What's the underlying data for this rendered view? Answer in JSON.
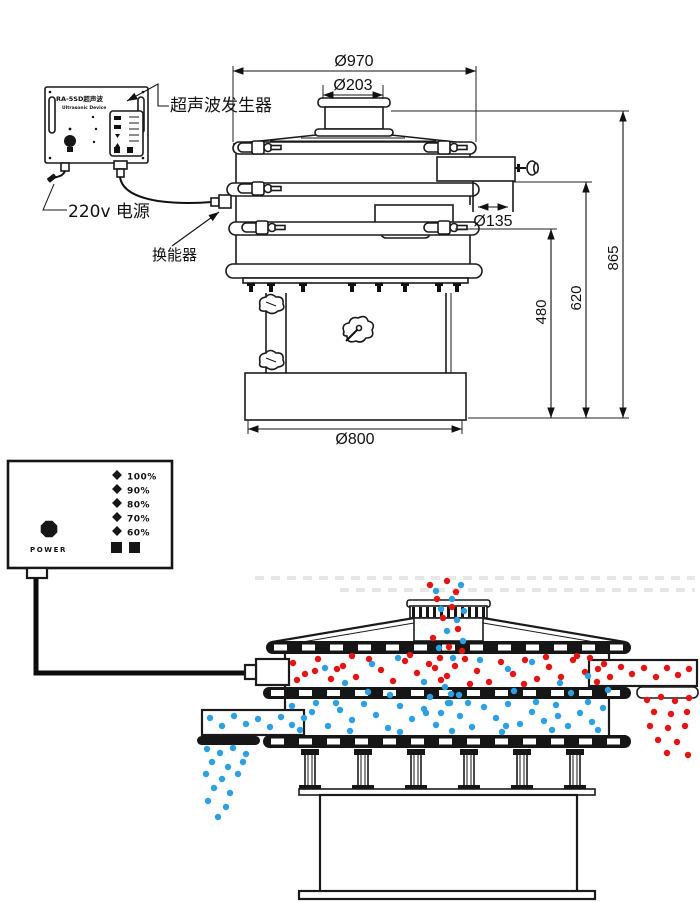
{
  "top_diagram": {
    "generator_box": {
      "title": "RA-5SD超声波",
      "subtitle": "Ultrasonic Device"
    },
    "labels": {
      "generator": "超声波发生器",
      "power": "220v 电源",
      "transducer": "换能器"
    },
    "dimensions": {
      "top_diameter": "Ø970",
      "inlet_diameter": "Ø203",
      "outlet_diameter": "Ø135",
      "lower_outlet_height": "480",
      "upper_outlet_height": "620",
      "total_height": "865",
      "base_diameter": "Ø800"
    }
  },
  "controller": {
    "power_levels": [
      "100%",
      "90%",
      "80%",
      "70%",
      "60%"
    ],
    "knob_label": "POWER"
  },
  "colors": {
    "red": "#e41414",
    "blue": "#2d9fe3",
    "line": "#1a1a1a"
  },
  "illustration": {
    "particles": {
      "feed_red": {
        "color": "red",
        "r": 3.2,
        "points": [
          [
            430,
            585
          ],
          [
            447,
            581
          ],
          [
            456,
            592
          ],
          [
            437,
            599
          ],
          [
            452,
            607
          ],
          [
            443,
            618
          ],
          [
            458,
            629
          ],
          [
            433,
            638
          ],
          [
            449,
            647
          ],
          [
            462,
            651
          ],
          [
            440,
            658
          ],
          [
            455,
            666
          ],
          [
            447,
            676
          ],
          [
            435,
            668
          ]
        ]
      },
      "feed_blue": {
        "color": "blue",
        "r": 3.2,
        "points": [
          [
            461,
            585
          ],
          [
            436,
            591
          ],
          [
            452,
            599
          ],
          [
            464,
            611
          ],
          [
            441,
            609
          ],
          [
            457,
            620
          ],
          [
            447,
            631
          ],
          [
            463,
            641
          ],
          [
            439,
            648
          ],
          [
            453,
            658
          ],
          [
            445,
            687
          ],
          [
            459,
            695
          ],
          [
            450,
            703
          ],
          [
            441,
            713
          ]
        ]
      },
      "upper_red": {
        "color": "red",
        "r": 3.2,
        "points": [
          [
            293,
            663
          ],
          [
            305,
            674
          ],
          [
            318,
            659
          ],
          [
            331,
            679
          ],
          [
            343,
            666
          ],
          [
            356,
            677
          ],
          [
            369,
            659
          ],
          [
            381,
            670
          ],
          [
            393,
            681
          ],
          [
            405,
            661
          ],
          [
            417,
            673
          ],
          [
            429,
            664
          ],
          [
            441,
            680
          ],
          [
            465,
            659
          ],
          [
            477,
            671
          ],
          [
            489,
            682
          ],
          [
            501,
            662
          ],
          [
            513,
            674
          ],
          [
            525,
            660
          ],
          [
            537,
            679
          ],
          [
            549,
            667
          ],
          [
            561,
            677
          ],
          [
            573,
            660
          ],
          [
            585,
            672
          ],
          [
            597,
            682
          ],
          [
            604,
            664
          ],
          [
            297,
            680
          ],
          [
            352,
            656
          ],
          [
            410,
            655
          ],
          [
            470,
            684
          ],
          [
            524,
            684
          ],
          [
            577,
            656
          ],
          [
            337,
            669
          ],
          [
            546,
            657
          ],
          [
            590,
            658
          ],
          [
            315,
            671
          ]
        ]
      },
      "upper_blue": {
        "color": "blue",
        "r": 3.2,
        "points": [
          [
            325,
            668
          ],
          [
            372,
            664
          ],
          [
            398,
            658
          ],
          [
            424,
            682
          ],
          [
            480,
            660
          ],
          [
            508,
            669
          ],
          [
            532,
            662
          ],
          [
            560,
            683
          ],
          [
            588,
            676
          ],
          [
            345,
            683
          ],
          [
            368,
            692
          ],
          [
            451,
            694
          ],
          [
            514,
            691
          ],
          [
            571,
            693
          ],
          [
            608,
            690
          ],
          [
            390,
            695
          ],
          [
            430,
            697
          ]
        ]
      },
      "right_red": {
        "color": "red",
        "r": 3.2,
        "points": [
          [
            598,
            669
          ],
          [
            610,
            677
          ],
          [
            621,
            667
          ],
          [
            632,
            674
          ],
          [
            644,
            668
          ],
          [
            656,
            677
          ],
          [
            667,
            668
          ],
          [
            678,
            675
          ],
          [
            689,
            669
          ],
          [
            647,
            700
          ],
          [
            661,
            697
          ],
          [
            675,
            701
          ],
          [
            689,
            698
          ],
          [
            654,
            712
          ],
          [
            671,
            714
          ],
          [
            687,
            712
          ],
          [
            650,
            726
          ],
          [
            668,
            728
          ],
          [
            685,
            726
          ],
          [
            658,
            740
          ],
          [
            677,
            742
          ],
          [
            667,
            753
          ],
          [
            688,
            755
          ]
        ]
      },
      "lower_blue": {
        "color": "blue",
        "r": 3.2,
        "points": [
          [
            292,
            706
          ],
          [
            304,
            718
          ],
          [
            316,
            703
          ],
          [
            328,
            726
          ],
          [
            340,
            710
          ],
          [
            352,
            720
          ],
          [
            364,
            704
          ],
          [
            376,
            715
          ],
          [
            388,
            728
          ],
          [
            400,
            706
          ],
          [
            412,
            719
          ],
          [
            424,
            709
          ],
          [
            436,
            725
          ],
          [
            448,
            703
          ],
          [
            460,
            716
          ],
          [
            472,
            727
          ],
          [
            484,
            707
          ],
          [
            496,
            718
          ],
          [
            508,
            704
          ],
          [
            520,
            724
          ],
          [
            532,
            712
          ],
          [
            544,
            721
          ],
          [
            556,
            705
          ],
          [
            568,
            726
          ],
          [
            580,
            713
          ],
          [
            592,
            722
          ],
          [
            603,
            708
          ],
          [
            300,
            730
          ],
          [
            350,
            731
          ],
          [
            400,
            732
          ],
          [
            452,
            731
          ],
          [
            502,
            732
          ],
          [
            552,
            730
          ],
          [
            598,
            730
          ],
          [
            312,
            712
          ],
          [
            426,
            713
          ],
          [
            536,
            702
          ],
          [
            588,
            702
          ],
          [
            336,
            703
          ],
          [
            558,
            716
          ],
          [
            468,
            703
          ],
          [
            506,
            726
          ]
        ]
      },
      "left_blue": {
        "color": "blue",
        "r": 3.2,
        "points": [
          [
            210,
            718
          ],
          [
            222,
            726
          ],
          [
            234,
            716
          ],
          [
            246,
            724
          ],
          [
            258,
            719
          ],
          [
            270,
            727
          ],
          [
            281,
            717
          ],
          [
            292,
            725
          ],
          [
            207,
            749
          ],
          [
            220,
            753
          ],
          [
            233,
            748
          ],
          [
            246,
            754
          ],
          [
            212,
            762
          ],
          [
            228,
            767
          ],
          [
            243,
            762
          ],
          [
            206,
            774
          ],
          [
            222,
            779
          ],
          [
            238,
            774
          ],
          [
            214,
            788
          ],
          [
            230,
            793
          ],
          [
            208,
            801
          ],
          [
            226,
            807
          ],
          [
            218,
            817
          ]
        ]
      }
    }
  }
}
